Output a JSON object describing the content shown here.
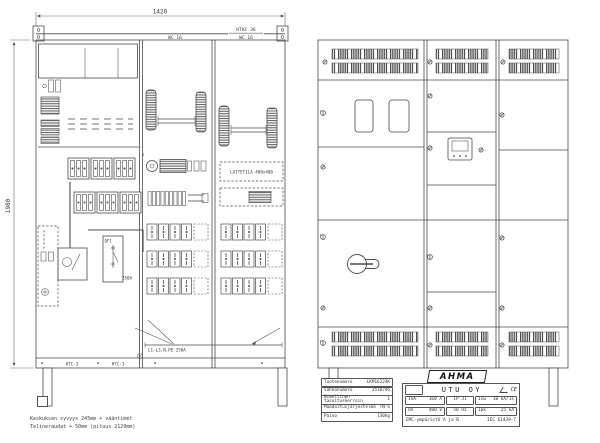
{
  "dimensions": {
    "width": "1420",
    "height": "1980"
  },
  "cabinet_labels": {
    "duct_mid": "WC 16",
    "duct_top_right_upper": "HTKC 36",
    "duct_top_right_lower": "WC 16",
    "device_space": "LAITETILA  400x400",
    "busbar": "L1-L3,N,PE 250A",
    "breaker": "QF1",
    "breaker_rating": "250A",
    "plinth_left": "HTC-3",
    "plinth_right": "HTC-3",
    "aux": "S"
  },
  "notes": {
    "line1": "Keskuksen syvyys 245mm + vääntimet",
    "line2": "Telineraudat + 50mm (pituus 2120mm)"
  },
  "titleblock": {
    "product_rows": [
      {
        "label": "Tuotenumero",
        "value": "LKM16224K"
      },
      {
        "label": "Sähkönumero",
        "value": "3510746"
      },
      {
        "label": "Nimellinen tasoituskerroin",
        "value": "1"
      },
      {
        "label": "Maadoitusjärjestelmä",
        "value": "TN-S"
      },
      {
        "label": "Paino",
        "value": "130kg"
      }
    ],
    "brand": "AHMA",
    "company": "UTU OY",
    "ce_mark": "CE",
    "specs": {
      "ina_label": "InA",
      "ina_value": "160 A",
      "ip": "IP 31",
      "icw_label": "Icw",
      "icw_value": "10 kA/1s",
      "un_label": "Un",
      "un_value": "400 V",
      "hz": "50 Hz",
      "ipk_label": "Ipk",
      "ipk_value": "25 kA"
    },
    "emc": "EMC-ympäristö A ja B",
    "standard": "IEC 61439-7"
  },
  "icons": {
    "screw": "slotted-screw",
    "lock": "quarter-turn-lock",
    "handle": "rotary-switch-handle",
    "cert_mark": "scribble-mark"
  },
  "colors": {
    "line": "#4a4a4a",
    "text": "#3a3a3a",
    "grille": "#4d4d4d"
  }
}
